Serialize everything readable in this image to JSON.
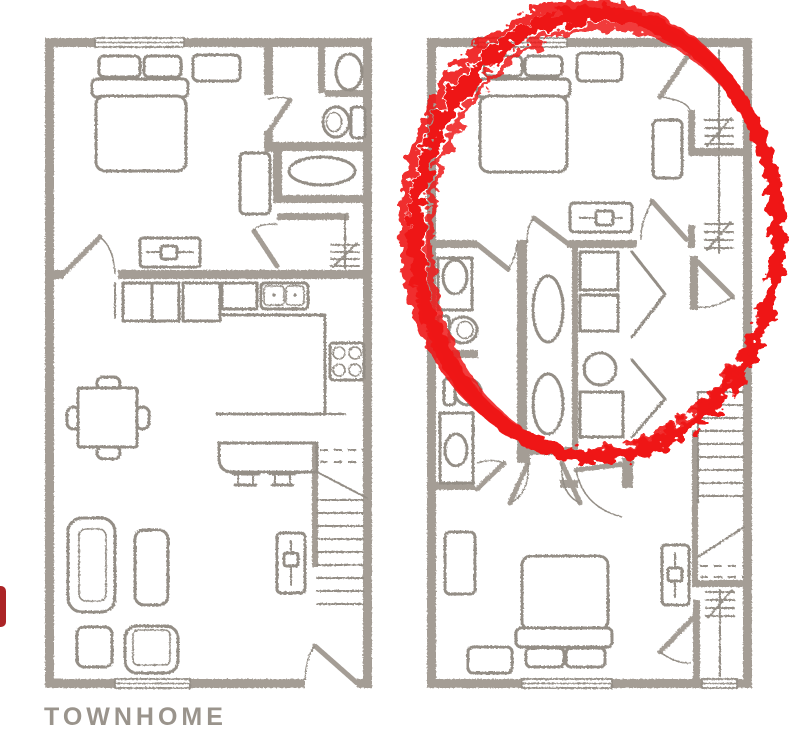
{
  "title": {
    "label": "TOWNHOME"
  },
  "colors": {
    "background": "#ffffff",
    "wall": "#a49d95",
    "line": "#948e86",
    "annotation": "#ee1414",
    "edge_marker": "#ab2426",
    "title_color": "#9a948c"
  },
  "annotation": {
    "kind": "hand-drawn circle",
    "color": "#ee1414"
  },
  "icons": [
    "double-bed",
    "pillow",
    "nightstand",
    "dresser-tv",
    "wardrobe",
    "toilet",
    "sink",
    "bathtub",
    "closet-rod",
    "kitchen-cabinets",
    "double-kitchen-sink",
    "stove",
    "breakfast-bar",
    "bar-stool",
    "dining-table",
    "dining-chair",
    "sofa",
    "coffee-table",
    "ottoman",
    "armchair",
    "tv-stand",
    "staircase",
    "washer-dryer",
    "water-heater",
    "door-swing",
    "window",
    "bifold-door"
  ]
}
